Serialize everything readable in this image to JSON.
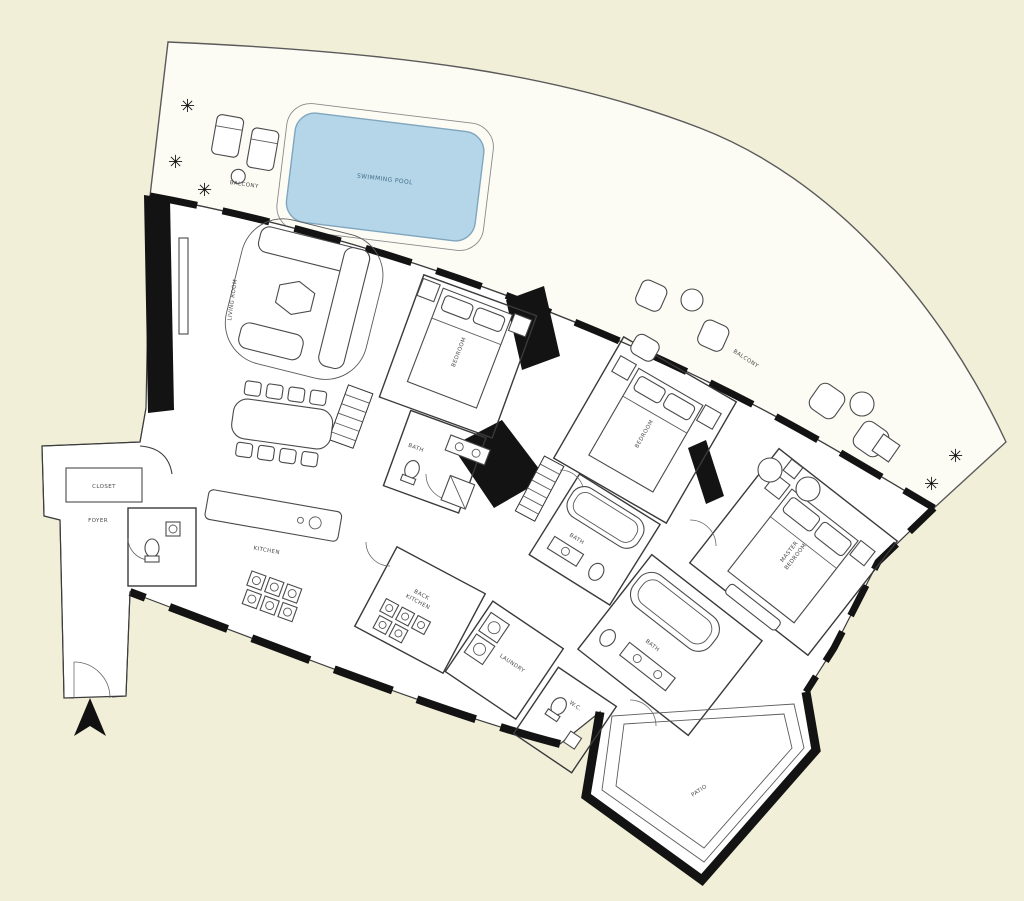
{
  "plan": {
    "labels": {
      "pool": "SWIMMING POOL",
      "balcony_top": "BALCONY",
      "balcony_right": "BALCONY",
      "living": "LIVING ROOM",
      "bedroom1": "BEDROOM",
      "bedroom2": "BEDROOM",
      "master_line1": "MASTER",
      "master_line2": "BEDROOM",
      "bath1": "BATH",
      "bath2": "BATH",
      "master_bath": "BATH",
      "kitchen": "KITCHEN",
      "back_kitchen_line1": "BACK",
      "back_kitchen_line2": "KITCHEN",
      "laundry": "LAUNDRY",
      "wc": "W.C.",
      "closet": "CLOSET",
      "foyer": "FOYER",
      "patio": "PATIO"
    },
    "colors": {
      "background": "#f2efd9",
      "pool_fill": "#b5d6e8",
      "pool_stroke": "#7fa6be",
      "wall": "#131313",
      "terrace_fill": "#fcfbf4",
      "interior_fill": "#ffffff"
    },
    "icons": {
      "plant": "✳",
      "north_arrow": "north-arrow"
    }
  }
}
